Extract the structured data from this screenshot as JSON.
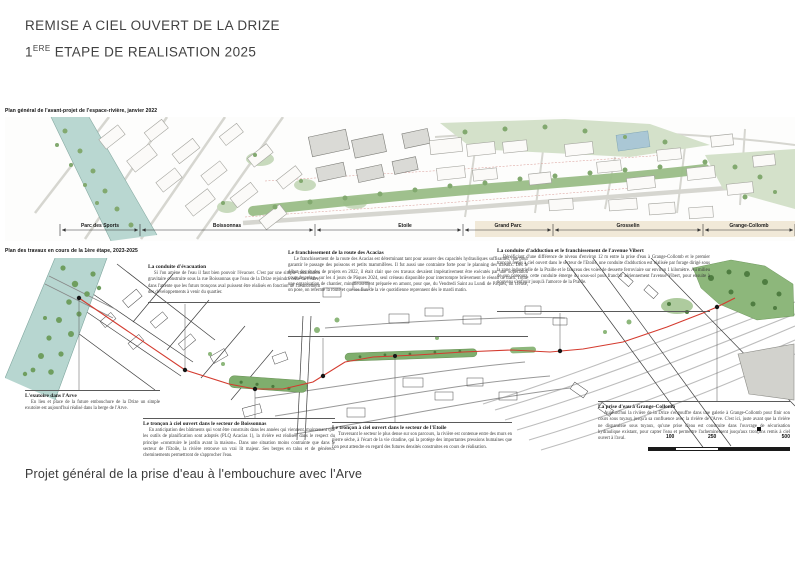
{
  "header": {
    "title_line1": "REMISE A CIEL OUVERT DE LA DRIZE",
    "title2_num": "1",
    "title2_sup": "ERE",
    "title2_rest": " ETAPE DE REALISATION 2025"
  },
  "map_top": {
    "caption": "Plan général de l'avant-projet de l'espace-rivière, janvier 2022",
    "sections": [
      "Parc des Sports",
      "Boissonnas",
      "Etoile",
      "Grand Parc",
      "Grosselin",
      "Grange-Collomb"
    ]
  },
  "map_bottom": {
    "caption": "Plan des travaux en cours de la 1ère étape, 2023-2025"
  },
  "annotations": [
    {
      "title": "La conduite d'évacuation",
      "body": "Si l'on amène de l'eau il faut bien pouvoir l'évacuer. C'est par une simple canalisation gravitaire construite sous la rue Boissonnas que l'eau de la Drize rejoindra celle de l'Arve, dans l'attente que les futurs tronçons aval puissent être réalisés en fonction de l'avancement des développements à venir du quartier."
    },
    {
      "title": "Le franchissement de la route des Acacias",
      "body": "Le franchissement de la route des Acacias est déterminant tant pour assurer des capacités hydrauliques suffisantes, que pour garantir le passage des poissons et petits mammifères. Il fut aussi une contrainte forte pour le planning des travaux. Dès le début des études de projets en 2022, il était clair que ces travaux devaient impérativement être exécutés par une «opération coup de poing» sur les 4 jours de Pâques 2024, seul créneau disponible pour interrompre brièvement le réseau de tram. Toute une organisation de chantier, minutieusement préparée en amont, pour que, du Vendredi Saint au Lundi de Pâques, on creuse, on pose, on referme la route et que les flux de la vie quotidienne reprennent dès le mardi matin."
    },
    {
      "title": "La conduite d'adduction et le franchissement de l'avenue Vibert",
      "body": "Bénéficiant d'une différence de niveau d'environ 12 m entre la prise d'eau à Grange-Collomb et le premier tronçon remis à ciel ouvert dans le secteur de l'Etoile, une conduite d'adduction est réalisée par forage dirigé sous la zone industrielle de la Praille et le faisceau des voies de desserte ferroviaire sur environ 1 kilomètre. Au milieu de son parcours, cette conduite émerge du sous-sol pour franchir aériennement l'avenue Vibert, pour ensuite à nouveau s'enfouir jusqu'à l'amorce de la Praille."
    },
    {
      "title": "L'exutoire dans l'Arve",
      "body": "En lieu et place de la future embouchure de la Drize un simple exutoire est aujourd'hui réalisé dans la berge de l'Arve."
    },
    {
      "title": "Le tronçon à ciel ouvert dans le secteur de Boissonnas",
      "body": "En anticipation des bâtiments qui vont être construits dans les années qui viennent, maintenant que les outils de planification sont adoptés (PLQ Acacias 1), la rivière est réalisée dans le respect du principe «construire le jardin avant la maison». Dans une situation moins contrainte que dans le secteur de l'Etoile, la rivière retrouve un vrai lit majeur. Ses berges en talus et de généreux cheminements permettront de s'approcher l'eau."
    },
    {
      "title": "Le tronçon à ciel ouvert dans le secteur de l'Etoile",
      "body": "Traversant le secteur le plus dense sur son parcours, la rivière est contenue entre des murs en pierre sèche, à l'écart de la vie citadine, qui la protège des importantes pressions humaines que l'on peut attendre en regard des futures densités construites en cours de réalisation."
    },
    {
      "title": "La prise d'eau à Grange-Collomb",
      "body": "Aujourd'hui la rivière de la Drize s'engouffre dans une galerie à Grange-Collomb pour finir son cours sous tuyaux jusqu'à sa confluence avec la rivière de l'Arve. C'est ici, juste avant que la rivière ne disparaisse sous tuyaux, qu'une prise d'eau est construite dans l'ouvrage de sécurisation hydraulique existant, pour capter l'eau et permettre l'acheminement jusqu'aux tronçons remis à ciel ouvert à l'aval."
    }
  ],
  "footer": {
    "caption": "Projet général de la prise d'eau à l'embouchure avec l'Arve"
  },
  "scale_bar": {
    "labels": [
      "100",
      "250",
      "500"
    ]
  },
  "colors": {
    "conduit_red": "#d43b2f",
    "river_teal": "#b7d6d0",
    "open_river_green": "#7fae6d",
    "light_green": "#d4e1ca"
  }
}
